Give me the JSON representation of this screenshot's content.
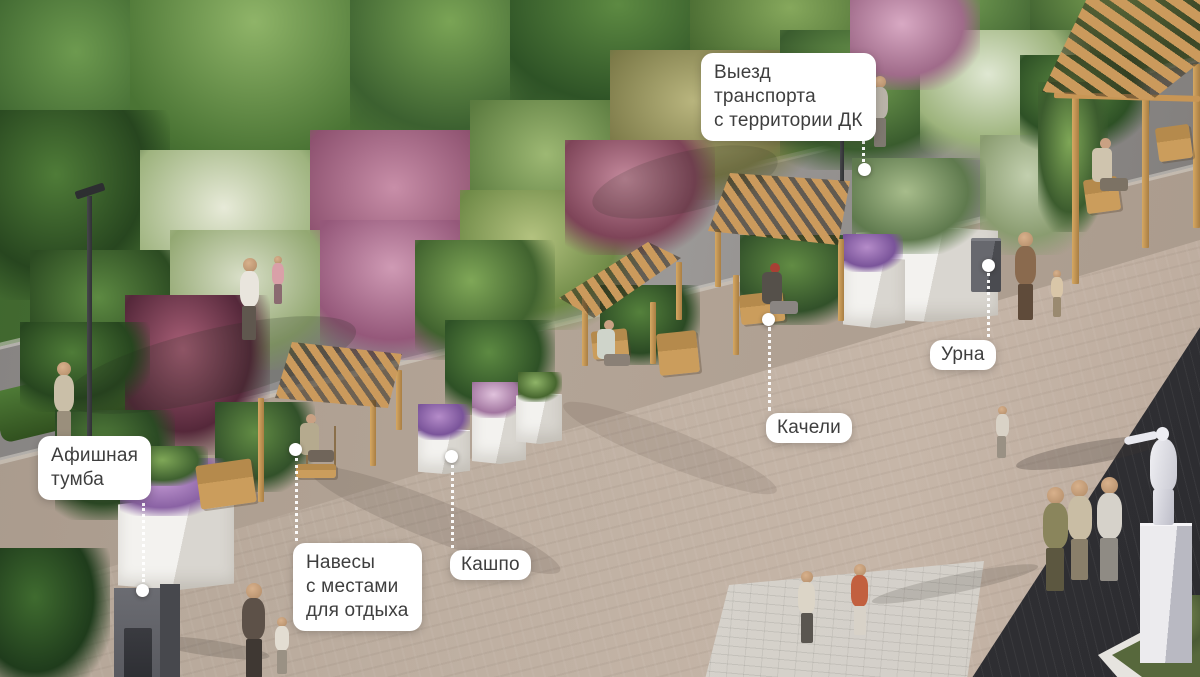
{
  "annotations": [
    {
      "id": "vehicle-exit",
      "text": "Выезд\nтранспорта\nс территории ДК"
    },
    {
      "id": "urn",
      "text": "Урна"
    },
    {
      "id": "swings",
      "text": "Качели"
    },
    {
      "id": "planter",
      "text": "Кашпо"
    },
    {
      "id": "canopies",
      "text": "Навесы\nс местами\nдля отдыха"
    },
    {
      "id": "poster-column",
      "text": "Афишная\nтумба"
    }
  ],
  "colors": {
    "label_background": "#ffffff",
    "label_text": "#3e3e3e",
    "leader_line": "#ffffff",
    "canopy_wood": "#cb9a5c",
    "road_asphalt": "#8e8b89",
    "plaza_paving": "#bcab9c",
    "dark_paving": "#39393d",
    "vegetation_green": "#4e7a38",
    "planter_white": "#ebe9e4",
    "statue_white": "#ececf1"
  }
}
